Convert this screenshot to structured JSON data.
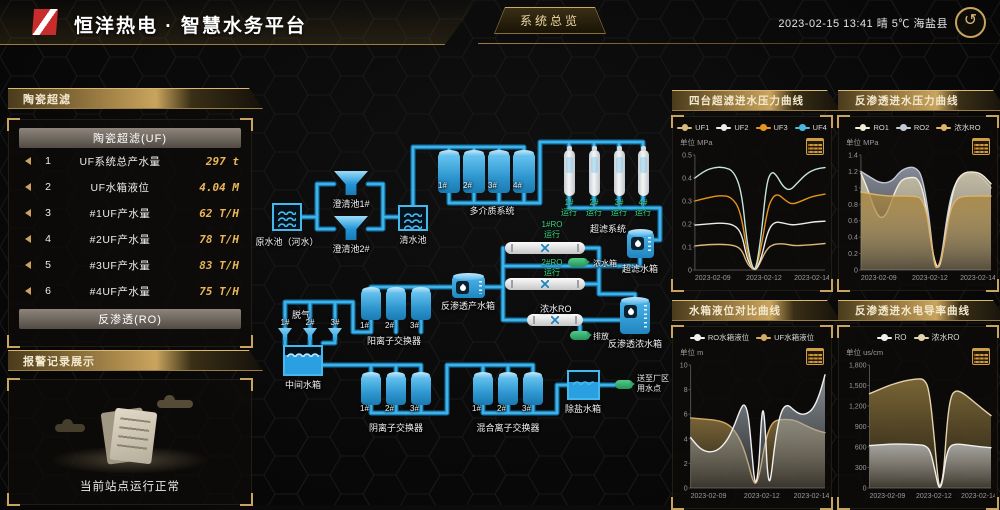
{
  "header": {
    "title": "恒洋热电 · 智慧水务平台",
    "nav_button": "系统总览",
    "datetime": "2023-02-15 13:41",
    "weather": "晴 5℃",
    "location": "海盐县",
    "back_icon": "↺"
  },
  "left": {
    "uf_panel": {
      "header": "陶瓷超滤",
      "table_title": "陶瓷超滤(UF)",
      "rows": [
        {
          "index": "1",
          "name": "UF系统总产水量",
          "value": "297 t"
        },
        {
          "index": "2",
          "name": "UF水箱液位",
          "value": "4.04 M"
        },
        {
          "index": "3",
          "name": "#1UF产水量",
          "value": "62 T/H"
        },
        {
          "index": "4",
          "name": "#2UF产水量",
          "value": "78 T/H"
        },
        {
          "index": "5",
          "name": "#3UF产水量",
          "value": "83 T/H"
        },
        {
          "index": "6",
          "name": "#4UF产水量",
          "value": "75 T/H"
        }
      ],
      "ro_title": "反渗透(RO)"
    },
    "alarm_panel": {
      "header": "报警记录展示",
      "status_text": "当前站点运行正常"
    }
  },
  "diagram": {
    "labels": {
      "raw_pool": "原水池（河水）",
      "clarifier1": "澄清池1#",
      "clarifier2": "澄清池2#",
      "clear_pool": "清水池",
      "multimedia_system": "多介质系统",
      "multimedia_units": [
        "1#",
        "2#",
        "3#",
        "4#"
      ],
      "uf_system": "超滤系统",
      "uf_unit_status": [
        "1# 运行",
        "2# 运行",
        "3# 运行",
        "4# 运行"
      ],
      "uf_tank": "超滤水箱",
      "ro1_status": "1#RO 运行",
      "ro2_status": "2#RO 运行",
      "conc_badge": "浓水箱",
      "conc_ro": "浓水RO",
      "discharge_badge": "排放",
      "ro_conc_tank": "反渗透浓水箱",
      "ro_prod_tank": "反渗透产水箱",
      "degas": "脱气",
      "degas_units": [
        "1#",
        "2#",
        "3#"
      ],
      "cation": "阳离子交换器",
      "cation_units": [
        "1#",
        "2#",
        "3#"
      ],
      "mid_tank": "中间水箱",
      "anion": "阴离子交换器",
      "anion_units": [
        "1#",
        "2#",
        "3#"
      ],
      "mixed": "混合离子交换器",
      "mixed_units": [
        "1#",
        "2#",
        "3#"
      ],
      "demin_tank": "除盐水箱",
      "supply_badge": "送至厂区 用水点"
    }
  },
  "chart_data": [
    {
      "type": "line",
      "title": "四台超滤进水压力曲线",
      "unit": "单位 MPa",
      "ylim": [
        0,
        0.5
      ],
      "yticks": [
        "0.5",
        "0.4",
        "0.3",
        "0.2",
        "0.1",
        "0"
      ],
      "x_labels": [
        "2023-02-09",
        "2023-02-12",
        "2023-02-14"
      ],
      "legend_position": "top",
      "grid": false,
      "series": [
        {
          "name": "UF1",
          "color": "#d9b87c",
          "points": [
            [
              0,
              0.105
            ],
            [
              0.08,
              0.11
            ],
            [
              0.2,
              0.112
            ],
            [
              0.3,
              0.108
            ],
            [
              0.36,
              0.09
            ],
            [
              0.4,
              0.03
            ],
            [
              0.44,
              0.005
            ],
            [
              0.47,
              0
            ],
            [
              0.5,
              0.03
            ],
            [
              0.55,
              0.09
            ],
            [
              0.6,
              0.112
            ],
            [
              0.68,
              0.115
            ],
            [
              0.76,
              0.105
            ],
            [
              0.85,
              0.108
            ],
            [
              1,
              0.115
            ]
          ]
        },
        {
          "name": "UF2",
          "color": "#ececec",
          "points": [
            [
              0,
              0.195
            ],
            [
              0.1,
              0.2
            ],
            [
              0.2,
              0.205
            ],
            [
              0.3,
              0.198
            ],
            [
              0.36,
              0.16
            ],
            [
              0.4,
              0.05
            ],
            [
              0.44,
              0.01
            ],
            [
              0.47,
              0
            ],
            [
              0.51,
              0.05
            ],
            [
              0.56,
              0.17
            ],
            [
              0.61,
              0.21
            ],
            [
              0.68,
              0.205
            ],
            [
              0.74,
              0.195
            ],
            [
              0.82,
              0.2
            ],
            [
              0.92,
              0.21
            ],
            [
              1,
              0.212
            ]
          ]
        },
        {
          "name": "UF3",
          "color": "#e2951c",
          "points": [
            [
              0,
              0.3
            ],
            [
              0.1,
              0.315
            ],
            [
              0.2,
              0.325
            ],
            [
              0.28,
              0.318
            ],
            [
              0.35,
              0.26
            ],
            [
              0.4,
              0.08
            ],
            [
              0.44,
              0.01
            ],
            [
              0.47,
              0
            ],
            [
              0.51,
              0.1
            ],
            [
              0.56,
              0.27
            ],
            [
              0.6,
              0.32
            ],
            [
              0.64,
              0.33
            ],
            [
              0.7,
              0.3
            ],
            [
              0.75,
              0.285
            ],
            [
              0.82,
              0.3
            ],
            [
              0.9,
              0.32
            ],
            [
              1,
              0.33
            ]
          ]
        },
        {
          "name": "UF4",
          "color": "#49b8dc",
          "stroke": "#c5e4de",
          "points": [
            [
              0,
              0.4
            ],
            [
              0.07,
              0.43
            ],
            [
              0.14,
              0.445
            ],
            [
              0.22,
              0.448
            ],
            [
              0.3,
              0.43
            ],
            [
              0.36,
              0.34
            ],
            [
              0.4,
              0.12
            ],
            [
              0.44,
              0.01
            ],
            [
              0.47,
              0
            ],
            [
              0.51,
              0.15
            ],
            [
              0.55,
              0.38
            ],
            [
              0.59,
              0.43
            ],
            [
              0.63,
              0.41
            ],
            [
              0.68,
              0.36
            ],
            [
              0.73,
              0.345
            ],
            [
              0.79,
              0.38
            ],
            [
              0.86,
              0.42
            ],
            [
              0.93,
              0.44
            ],
            [
              1,
              0.445
            ]
          ]
        }
      ]
    },
    {
      "type": "area",
      "title": "反渗透进水压力曲线",
      "unit": "单位 MPa",
      "ylim": [
        0,
        1.4
      ],
      "yticks": [
        "1.4",
        "1.2",
        "1",
        "0.8",
        "0.6",
        "0.4",
        "0.2",
        "0"
      ],
      "x_labels": [
        "2023-02-09",
        "2023-02-12",
        "2023-02-14"
      ],
      "legend_position": "top",
      "grid": false,
      "draw_order": [
        1,
        0,
        2
      ],
      "series": [
        {
          "name": "RO1",
          "color": "#f2ecd9",
          "fill": "#cdc2a4",
          "points": [
            [
              0,
              1.18
            ],
            [
              0.05,
              1.0
            ],
            [
              0.1,
              0.75
            ],
            [
              0.15,
              0.62
            ],
            [
              0.2,
              0.68
            ],
            [
              0.26,
              0.95
            ],
            [
              0.31,
              1.1
            ],
            [
              0.38,
              1.13
            ],
            [
              0.44,
              1.12
            ],
            [
              0.49,
              0.9
            ],
            [
              0.54,
              0.3
            ],
            [
              0.585,
              0
            ],
            [
              0.62,
              0.1
            ],
            [
              0.67,
              0.65
            ],
            [
              0.72,
              1.05
            ],
            [
              0.78,
              1.18
            ],
            [
              0.86,
              1.2
            ],
            [
              0.93,
              1.17
            ],
            [
              1,
              1.05
            ]
          ]
        },
        {
          "name": "RO2",
          "color": "#c2c9d6",
          "fill": "#99a1b0",
          "points": [
            [
              0,
              1.2
            ],
            [
              0.08,
              1.12
            ],
            [
              0.16,
              1.05
            ],
            [
              0.24,
              1.08
            ],
            [
              0.3,
              1.2
            ],
            [
              0.36,
              1.25
            ],
            [
              0.42,
              1.25
            ],
            [
              0.47,
              1.15
            ],
            [
              0.52,
              0.7
            ],
            [
              0.56,
              0.1
            ],
            [
              0.585,
              0
            ],
            [
              0.62,
              0.15
            ],
            [
              0.67,
              0.75
            ],
            [
              0.72,
              1.05
            ],
            [
              0.78,
              1.15
            ],
            [
              0.85,
              1.18
            ],
            [
              0.92,
              1.15
            ],
            [
              1,
              1.0
            ]
          ]
        },
        {
          "name": "浓水RO",
          "color": "#ddb269",
          "fill": "#a8853e",
          "points": [
            [
              0,
              0.95
            ],
            [
              0.1,
              0.92
            ],
            [
              0.2,
              0.9
            ],
            [
              0.3,
              0.9
            ],
            [
              0.4,
              0.9
            ],
            [
              0.47,
              0.88
            ],
            [
              0.52,
              0.6
            ],
            [
              0.56,
              0.1
            ],
            [
              0.585,
              0
            ],
            [
              0.63,
              0.2
            ],
            [
              0.68,
              0.7
            ],
            [
              0.73,
              0.87
            ],
            [
              0.8,
              0.9
            ],
            [
              0.9,
              0.9
            ],
            [
              1,
              0.9
            ]
          ]
        }
      ]
    },
    {
      "type": "area",
      "title": "水箱液位对比曲线",
      "unit": "单位 m",
      "ylim": [
        0,
        10
      ],
      "yticks": [
        "10",
        "8",
        "6",
        "4",
        "2",
        "0"
      ],
      "x_labels": [
        "2023-02-09",
        "2023-02-12",
        "2023-02-14"
      ],
      "legend_position": "top",
      "grid": false,
      "draw_order": [
        1,
        0
      ],
      "series": [
        {
          "name": "RO水箱液位",
          "color": "#f0f0f0",
          "fill": "#9aa3ad",
          "points": [
            [
              0,
              4.1
            ],
            [
              0.05,
              3.4
            ],
            [
              0.1,
              3.0
            ],
            [
              0.16,
              2.9
            ],
            [
              0.22,
              3.2
            ],
            [
              0.28,
              4.0
            ],
            [
              0.33,
              5.2
            ],
            [
              0.37,
              6.4
            ],
            [
              0.4,
              6.9
            ],
            [
              0.43,
              6.0
            ],
            [
              0.455,
              3.0
            ],
            [
              0.475,
              0.6
            ],
            [
              0.49,
              0.4
            ],
            [
              0.51,
              2.0
            ],
            [
              0.525,
              5.5
            ],
            [
              0.54,
              6.6
            ],
            [
              0.555,
              5.0
            ],
            [
              0.57,
              1.5
            ],
            [
              0.585,
              0.4
            ],
            [
              0.6,
              1.0
            ],
            [
              0.62,
              3.0
            ],
            [
              0.65,
              5.2
            ],
            [
              0.68,
              6.4
            ],
            [
              0.72,
              6.8
            ],
            [
              0.76,
              6.4
            ],
            [
              0.81,
              6.0
            ],
            [
              0.86,
              6.0
            ],
            [
              0.91,
              6.4
            ],
            [
              0.96,
              7.6
            ],
            [
              1,
              9.2
            ]
          ]
        },
        {
          "name": "UF水箱液位",
          "color": "#d2ab62",
          "fill": "#8a7340",
          "points": [
            [
              0,
              5.7
            ],
            [
              0.1,
              5.6
            ],
            [
              0.2,
              5.5
            ],
            [
              0.28,
              5.2
            ],
            [
              0.34,
              4.5
            ],
            [
              0.39,
              3.4
            ],
            [
              0.43,
              2.0
            ],
            [
              0.465,
              0.5
            ],
            [
              0.49,
              0.3
            ],
            [
              0.52,
              1.5
            ],
            [
              0.55,
              3.5
            ],
            [
              0.59,
              5.0
            ],
            [
              0.63,
              5.5
            ],
            [
              0.7,
              5.6
            ],
            [
              0.78,
              5.5
            ],
            [
              0.85,
              5.1
            ],
            [
              0.93,
              4.7
            ],
            [
              1,
              4.5
            ]
          ]
        }
      ]
    },
    {
      "type": "area",
      "title": "反渗透进水电导率曲线",
      "unit": "单位 us/cm",
      "ylim": [
        0,
        1800
      ],
      "yticks": [
        "1,800",
        "1,500",
        "1,200",
        "900",
        "600",
        "300",
        "0"
      ],
      "x_labels": [
        "2023-02-09",
        "2023-02-12",
        "2023-02-14"
      ],
      "legend_position": "top",
      "grid": false,
      "draw_order": [
        1,
        0
      ],
      "series": [
        {
          "name": "RO",
          "color": "#f0f0f0",
          "fill": "#b5b5b5",
          "points": [
            [
              0,
              620
            ],
            [
              0.1,
              635
            ],
            [
              0.2,
              645
            ],
            [
              0.3,
              640
            ],
            [
              0.4,
              635
            ],
            [
              0.46,
              620
            ],
            [
              0.5,
              550
            ],
            [
              0.54,
              250
            ],
            [
              0.565,
              30
            ],
            [
              0.58,
              0
            ],
            [
              0.6,
              80
            ],
            [
              0.63,
              450
            ],
            [
              0.66,
              620
            ],
            [
              0.72,
              645
            ],
            [
              0.8,
              630
            ],
            [
              0.9,
              605
            ],
            [
              1,
              590
            ]
          ]
        },
        {
          "name": "浓水RO",
          "color": "#e3d3ac",
          "fill": "#8c753e",
          "points": [
            [
              0,
              1380
            ],
            [
              0.08,
              1440
            ],
            [
              0.16,
              1500
            ],
            [
              0.24,
              1545
            ],
            [
              0.32,
              1580
            ],
            [
              0.4,
              1600
            ],
            [
              0.45,
              1590
            ],
            [
              0.49,
              1450
            ],
            [
              0.53,
              800
            ],
            [
              0.565,
              100
            ],
            [
              0.58,
              0
            ],
            [
              0.61,
              200
            ],
            [
              0.64,
              1000
            ],
            [
              0.67,
              1350
            ],
            [
              0.71,
              1430
            ],
            [
              0.76,
              1400
            ],
            [
              0.82,
              1320
            ],
            [
              0.9,
              1200
            ],
            [
              1,
              1060
            ]
          ]
        }
      ]
    }
  ]
}
